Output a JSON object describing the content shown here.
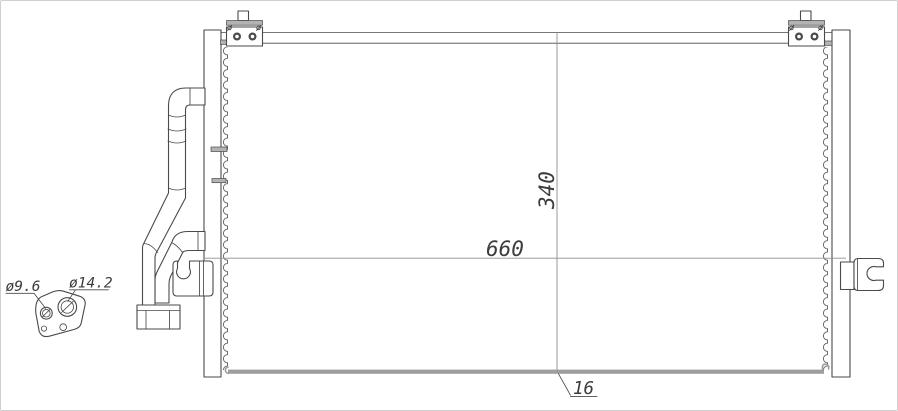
{
  "title": "condenser-engineering-drawing",
  "labels": {
    "core_height": "340",
    "core_width": "660",
    "core_depth": "16",
    "port_small_dia": "ø9.6",
    "port_large_dia": "ø14.2"
  },
  "colors": {
    "line": "#4a4a4a",
    "dim": "#8f8f8f",
    "gray": "#b3b3b3",
    "bar": "#9e9e9e",
    "text": "#3c3c3c",
    "bg": "#ffffff"
  }
}
